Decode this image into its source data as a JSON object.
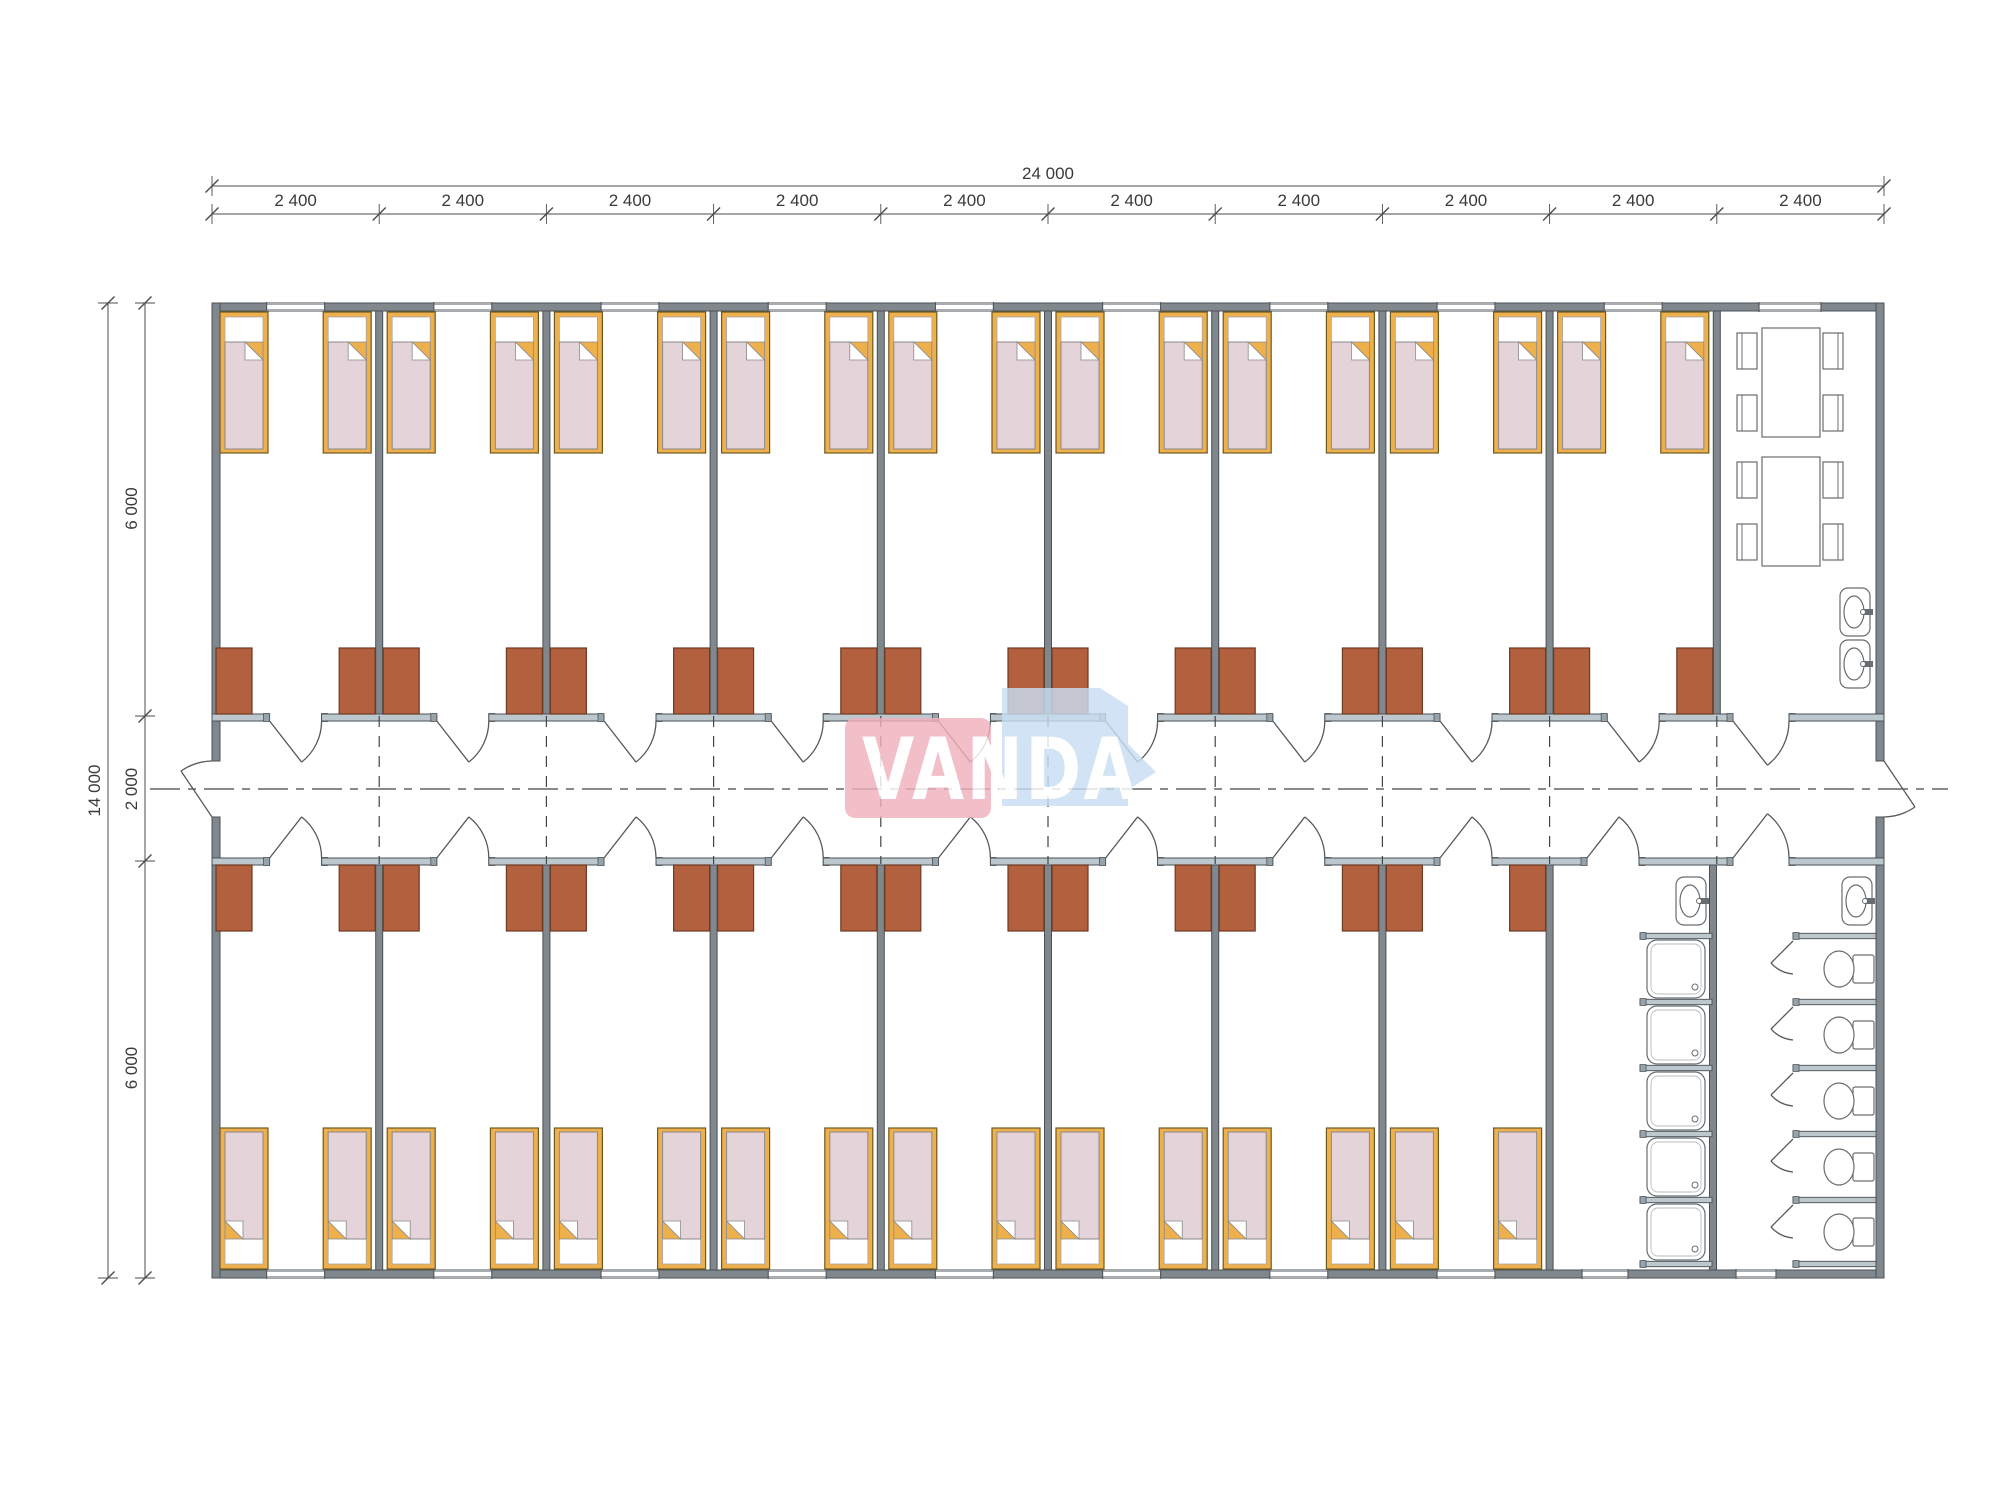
{
  "watermark": {
    "text": "VANDA",
    "pink_color": "#f0b0bc",
    "blue_color": "#c8def2",
    "text_color": "#ffffff"
  },
  "dimensions": {
    "top_total": "24 000",
    "top_segments": [
      "2 400",
      "2 400",
      "2 400",
      "2 400",
      "2 400",
      "2 400",
      "2 400",
      "2 400",
      "2 400",
      "2 400"
    ],
    "left_total": "14 000",
    "left_segments": [
      "6 000",
      "2 000",
      "6 000"
    ]
  },
  "layout_counts": {
    "modules": 10,
    "bedrooms_top": 9,
    "bedrooms_bottom": 8,
    "beds_per_room": 2,
    "wardrobes_per_room": 2,
    "dining_tables": 2,
    "chairs_per_table": 4,
    "dining_sinks": 2,
    "washroom_sinks": 2,
    "showers": 5,
    "toilet_stalls": 5
  },
  "colors": {
    "wall": "#80888e",
    "wall_stroke": "#4a5055",
    "corridor_wall": "#bcc8ce",
    "corridor_cap": "#97a3ab",
    "line": "#565b5f",
    "bed_frame": "#eeaf4d",
    "bed_frame_stroke": "#6d5a20",
    "mattress": "#ffffff",
    "blanket": "#e5d3da",
    "blanket_stroke": "#8a8a8a",
    "wardrobe": "#b2603e",
    "wardrobe_stroke": "#6e3a22",
    "fixture_stroke": "#686d71",
    "dim_text": "#3a3a3a"
  }
}
